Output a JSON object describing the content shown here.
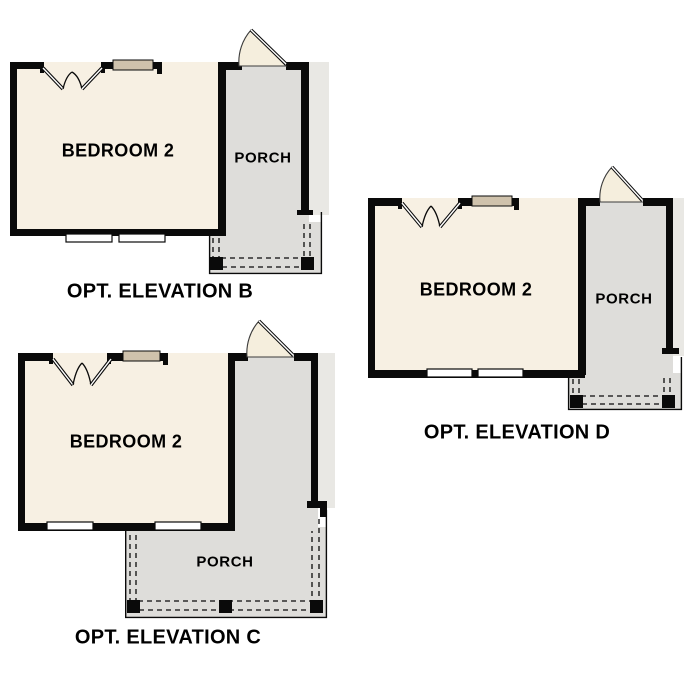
{
  "page": {
    "background": "#ffffff"
  },
  "colors": {
    "wall": "#0a0a0a",
    "room": "#f7f0e3",
    "porch": "#deddda",
    "roof": "#e9e8e4",
    "opening": "#cfc2ac",
    "door": "#f5eedd",
    "ink": "#000000"
  },
  "plans": [
    {
      "id": "elevation-b",
      "room_label": "BEDROOM 2",
      "porch_label": "PORCH",
      "caption": "OPT. ELEVATION B"
    },
    {
      "id": "elevation-c",
      "room_label": "BEDROOM 2",
      "porch_label": "PORCH",
      "caption": "OPT. ELEVATION C"
    },
    {
      "id": "elevation-d",
      "room_label": "BEDROOM 2",
      "porch_label": "PORCH",
      "caption": "OPT. ELEVATION D"
    }
  ]
}
